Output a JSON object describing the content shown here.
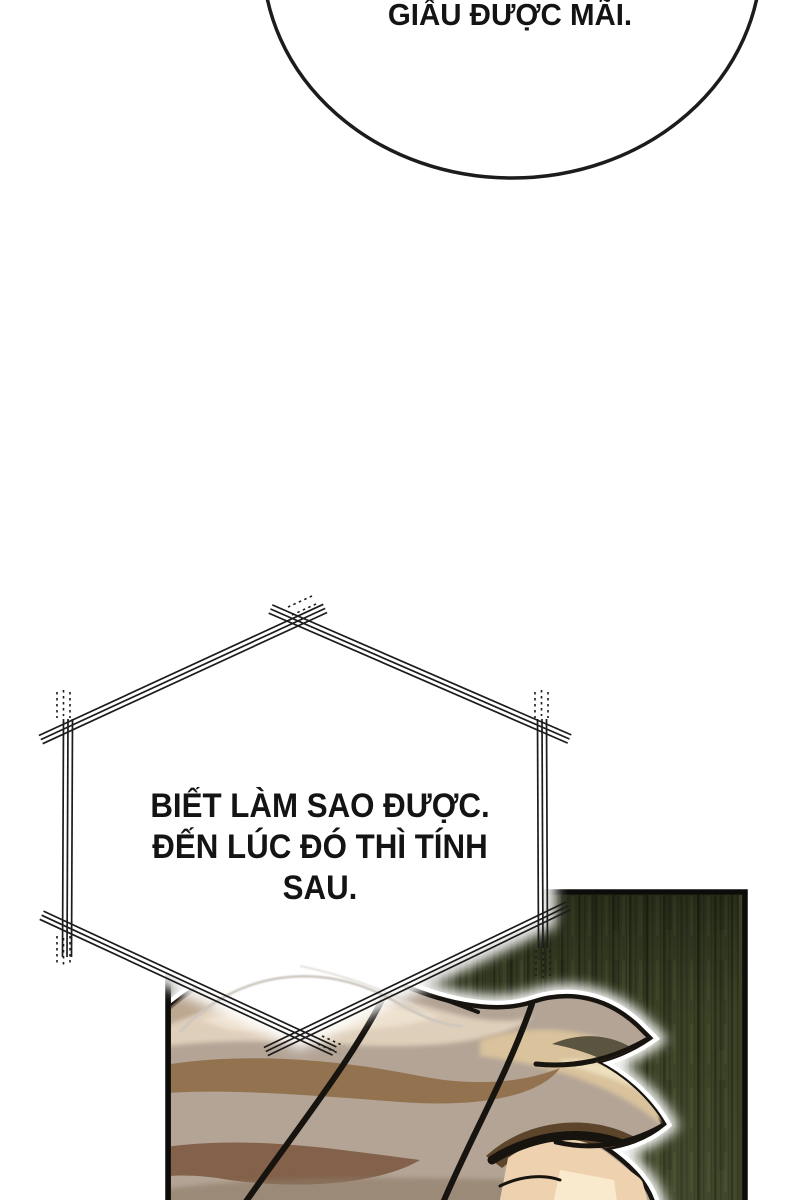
{
  "comic": {
    "bubble_top": {
      "text": "GIẤU ĐƯỢC MÃI."
    },
    "bubble_hex": {
      "lines": [
        "BIẾT LÀM SAO ĐƯỢC.",
        "ĐẾN LÚC ĐÓ THÌ TÍNH",
        "SAU."
      ]
    },
    "colors": {
      "ink": "#1c1c1c",
      "panel_green": "#3a4125",
      "panel_border": "#0c0d0a",
      "hair_base": "#b3a496",
      "hair_highlight": "#e3d4c0",
      "hair_brown": "#93724f",
      "hair_dark_brown": "#5d452c",
      "skin": "#eed2b0",
      "outline_black": "#17130f",
      "glow_white": "#ffffff"
    }
  }
}
